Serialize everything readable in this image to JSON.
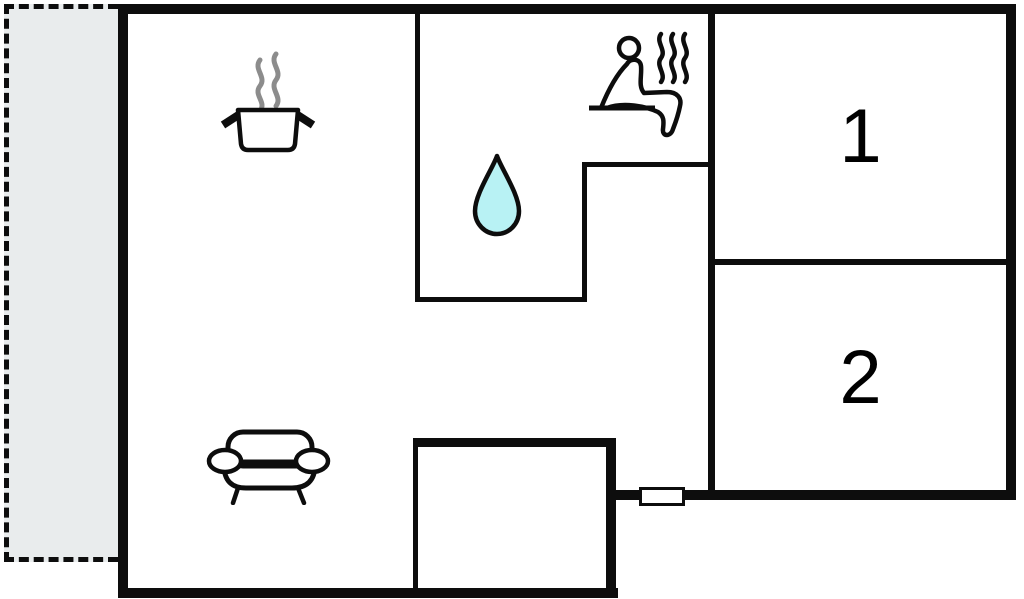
{
  "plan": {
    "type": "floor-plan",
    "rooms": {
      "room1": {
        "label": "1"
      },
      "room2": {
        "label": "2"
      }
    },
    "icons": {
      "kitchen": "cooking-pot-icon",
      "bathroom": "water-drop-icon",
      "sauna": "sauna-person-icon",
      "living": "sofa-icon",
      "entrance": "door-marker",
      "outdoor": "terrace-dashed-area"
    },
    "colors": {
      "wall": "#0d0d0d",
      "terrace_fill": "#e9eced",
      "water_drop_fill": "#b8f2f4",
      "steam_gray": "#8c8c8c",
      "background": "#ffffff"
    }
  }
}
